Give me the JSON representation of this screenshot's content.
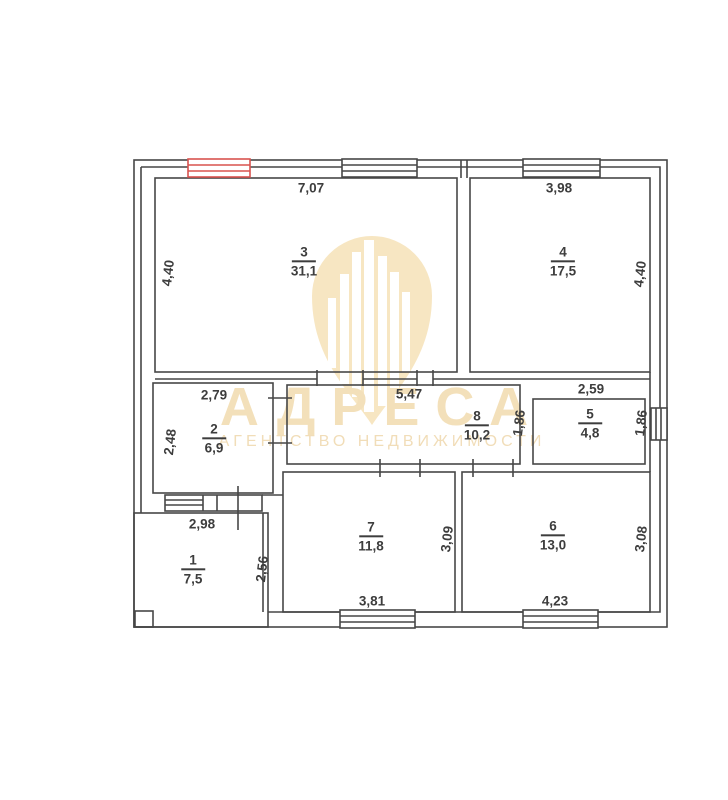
{
  "watermark": {
    "brand": "АДРЕСА",
    "tagline": "АГЕНТСТВО НЕДВИЖИМОСТИ",
    "logo": "building-pin-logo",
    "color": "#f3e0ba"
  },
  "plan": {
    "type": "floor-plan",
    "colors": {
      "wall": "#474747",
      "text": "#3d3d3d",
      "window_highlight": "#d9534f"
    },
    "rooms": [
      {
        "number": "1",
        "area": "7,5"
      },
      {
        "number": "2",
        "area": "6,9"
      },
      {
        "number": "3",
        "area": "31,1"
      },
      {
        "number": "4",
        "area": "17,5"
      },
      {
        "number": "5",
        "area": "4,8"
      },
      {
        "number": "6",
        "area": "13,0"
      },
      {
        "number": "7",
        "area": "11,8"
      },
      {
        "number": "8",
        "area": "10,2"
      }
    ],
    "dims": {
      "room3_width": "7,07",
      "room3_height": "4,40",
      "room4_width": "3,98",
      "room4_height": "4,40",
      "room2_width": "2,79",
      "room2_height": "2,48",
      "room8_width": "5,47",
      "room8_height": "1,86",
      "room5_width": "2,59",
      "room5_height": "1,86",
      "room1_width": "2,98",
      "room1_height": "2,56",
      "room7_width": "3,81",
      "room7_height": "3,09",
      "room6_width": "4,23",
      "room6_height": "3,08"
    }
  }
}
